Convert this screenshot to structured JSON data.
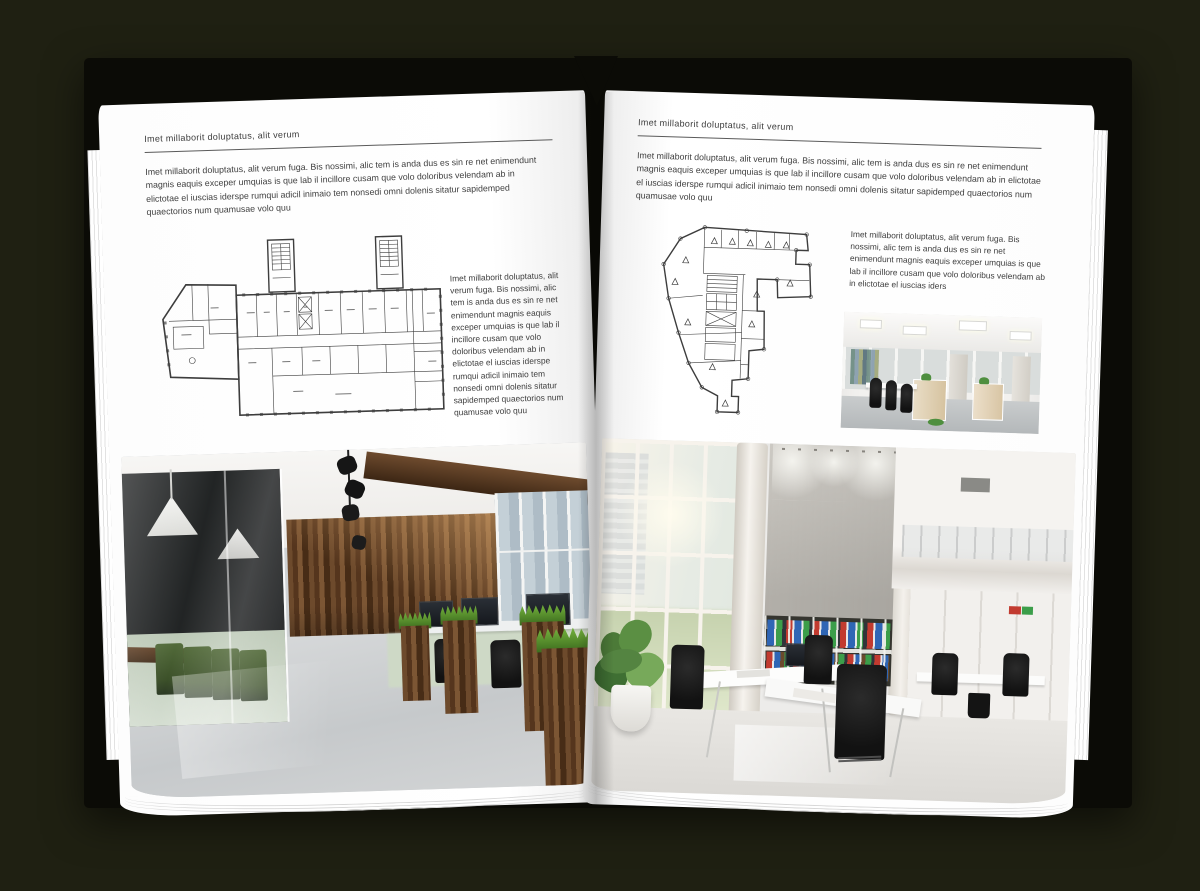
{
  "book": {
    "left_page": {
      "header": "Imet millaborit doluptatus, alit verum",
      "intro": "Imet millaborit doluptatus, alit verum fuga. Bis nossimi, alic tem is anda dus es sin re net enimendunt magnis eaquis exceper umquias is que lab il incillore cusam que volo doloribus velendam ab in elictotae el iuscias iderspe rumqui adicil inimaio tem nonsedi omni dolenis sitatur sapidemped quaectorios num quamusae volo quu",
      "side_text": "Imet millaborit doluptatus, alit verum fuga. Bis nossimi, alic tem is anda dus es sin re net enimendunt magnis eaquis exceper umquias is que lab il incillore cusam que volo doloribus velendam ab in elictotae el iuscias iderspe rumqui adicil inimaio tem nonsedi omni dolenis sitatur sapidemped quaectorios num quamusae volo quu"
    },
    "right_page": {
      "header": "Imet millaborit doluptatus, alit verum",
      "intro": "Imet millaborit doluptatus, alit verum fuga. Bis nossimi, alic tem is anda dus es sin re net enimendunt magnis eaquis exceper umquias is que lab il incillore cusam que volo doloribus velendam ab in elictotae el iuscias iderspe rumqui adicil inimaio tem nonsedi omni dolenis sitatur sapidemped quaectorios num quamusae volo quu",
      "side_text": "Imet millaborit doluptatus, alit verum fuga. Bis nossimi, alic tem is anda dus es sin re net enimendunt magnis eaquis exceper umquias is que lab il incillore cusam que volo doloribus velendam ab in elictotae el iuscias iders"
    }
  },
  "colors": {
    "background": "#1f2012",
    "cover": "#0b0b06",
    "page": "#ffffff",
    "plan_ink": "#3d3d3d",
    "wood_brown": "#6d4a2c",
    "chair_green": "#45602e",
    "plant_green": "#5b8f43",
    "binder_blue": "#2f66b5",
    "binder_green": "#3c9e4a",
    "binder_red": "#c23b30"
  }
}
